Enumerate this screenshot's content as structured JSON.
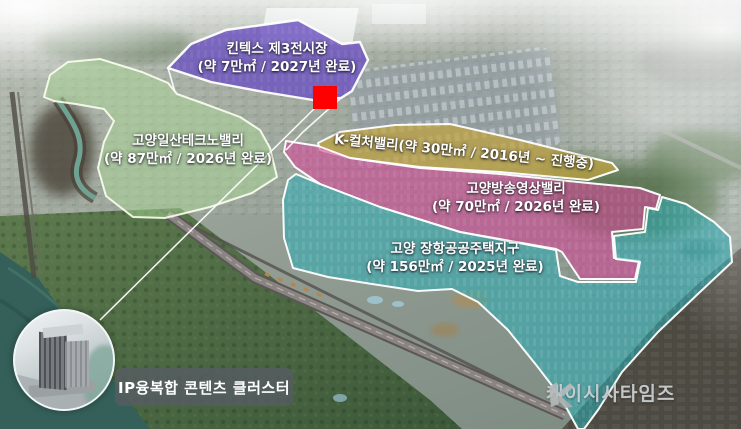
{
  "map": {
    "zones": {
      "kintex": {
        "name": "킨텍스 제3전시장",
        "detail": "(약 7만㎡ / 2027년 완료)",
        "color": "#6d53c0"
      },
      "techno": {
        "name": "고양일산테크노밸리",
        "detail": "(약 87만㎡ / 2026년 완료)",
        "color": "#a9d795"
      },
      "kculture": {
        "label": "K-컬처밸리(약 30만㎡ / 2016년 ~ 진행중)",
        "color": "#bfa23e"
      },
      "broadcast": {
        "name": "고양방송영상밸리",
        "detail": "(약 70만㎡ / 2026년 완료)",
        "color": "#d04a96"
      },
      "janghang": {
        "name": "고양 장항공공주택지구",
        "detail": "(약 156만㎡ / 2025년 완료)",
        "color": "#29adb6"
      }
    },
    "marker": {
      "color": "#fe0000"
    },
    "inset": {
      "label": "IP융복합 콘텐츠 클러스터"
    },
    "watermark": {
      "text": "케이시사타임즈"
    }
  }
}
